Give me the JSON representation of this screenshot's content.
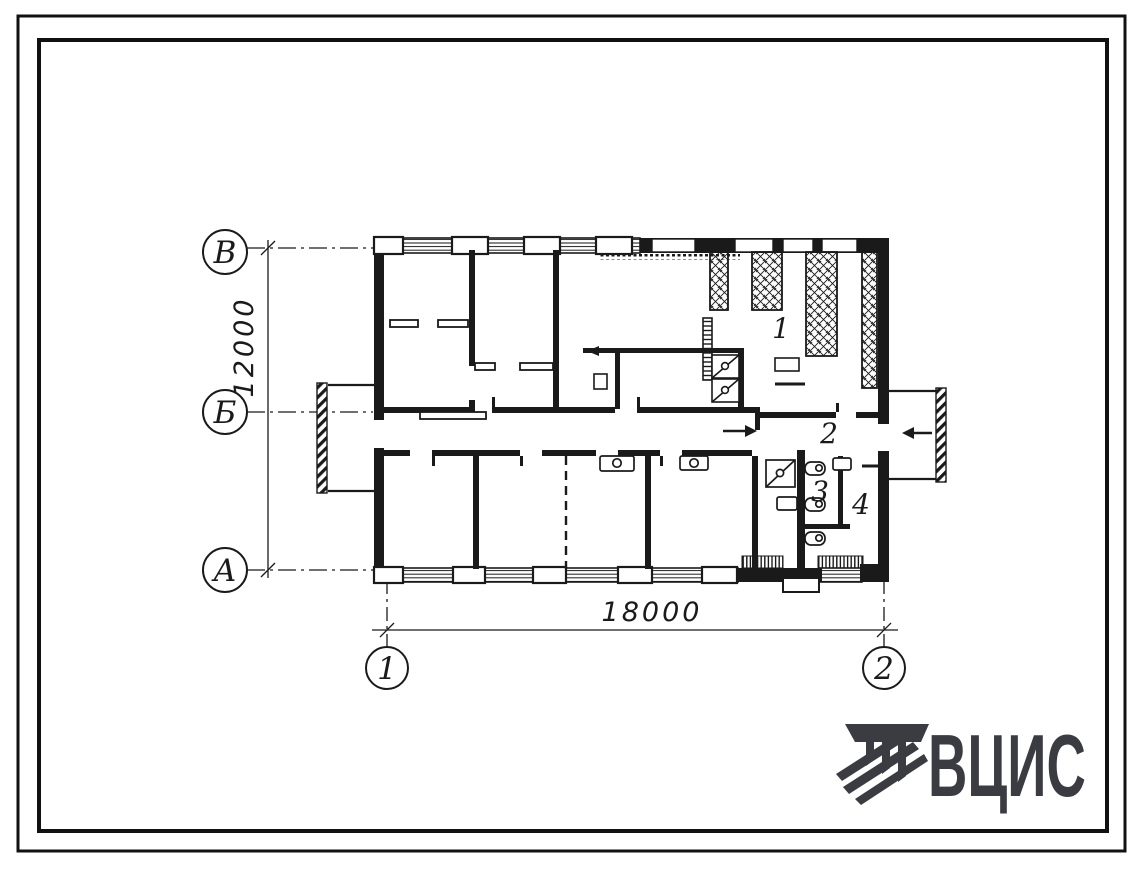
{
  "plan": {
    "row_axes": [
      {
        "label": "В"
      },
      {
        "label": "Б"
      },
      {
        "label": "А"
      }
    ],
    "col_axes": [
      {
        "label": "1"
      },
      {
        "label": "2"
      }
    ],
    "dim_vertical": "12000",
    "dim_horizontal": "18000",
    "rooms": [
      {
        "number": "1"
      },
      {
        "number": "2"
      },
      {
        "number": "3"
      },
      {
        "number": "4"
      }
    ]
  },
  "logo": {
    "text": "ВЦИС"
  },
  "colors": {
    "ink": "#1a1a1a",
    "logo": "#3b3b42",
    "paper": "#ffffff"
  }
}
